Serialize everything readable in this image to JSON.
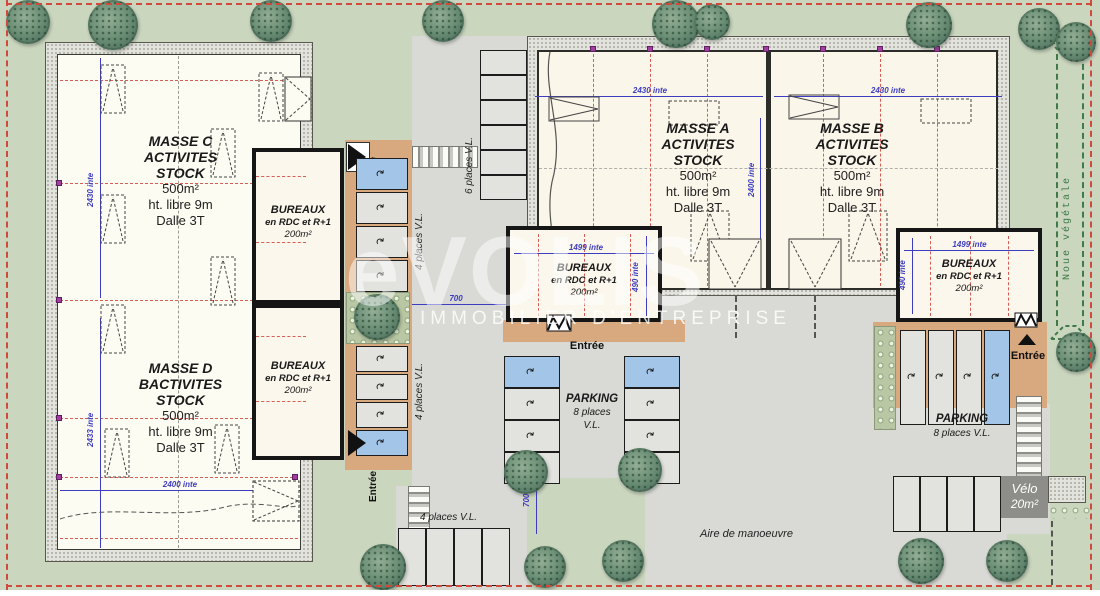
{
  "watermark": {
    "logo": "eVOLIS",
    "tagline": "IMMOBILIER D'ENTREPRISE"
  },
  "buildings": {
    "masse_c": {
      "lines": [
        "MASSE C",
        "ACTIVITES",
        "STOCK",
        "500m²",
        "ht. libre 9m",
        "Dalle 3T"
      ]
    },
    "masse_d": {
      "lines": [
        "MASSE D",
        "BACTIVITES",
        "STOCK",
        "500m²",
        "ht. libre 9m",
        "Dalle 3T"
      ]
    },
    "masse_a": {
      "lines": [
        "MASSE A",
        "ACTIVITES",
        "STOCK",
        "500m²",
        "ht. libre 9m",
        "Dalle 3T"
      ]
    },
    "masse_b": {
      "lines": [
        "MASSE B",
        "ACTIVITES",
        "STOCK",
        "500m²",
        "ht. libre 9m",
        "Dalle 3T"
      ]
    },
    "bureaux": {
      "lines": [
        "BUREAUX",
        "en RDC et R+1",
        "200m²"
      ]
    }
  },
  "labels": {
    "entree": "Entrée",
    "places4": "4 places V.L.",
    "places6": "6 places V.L.",
    "parking_central": [
      "PARKING",
      "8 places",
      "V.L."
    ],
    "parking_right": [
      "PARKING",
      "8 places V.L."
    ],
    "velo": [
      "Vélo",
      "20m²"
    ],
    "aire": "Aire de manoeuvre",
    "noue": "Noue végétale",
    "handicap_icon": "♿",
    "car_icon": "↷"
  },
  "dimensions": {
    "left_top_v": "2430 inte",
    "left_bottom_v": "2433 inte",
    "left_bottom_h": "2400 inte",
    "masse_a_h": "2430 inte",
    "masse_b_h": "2430 inte",
    "right_mid_v": "2400 inte",
    "bureaux_w": "1499 inte",
    "bureaux_h": "490 inte",
    "road_w": "700",
    "road_s": "700"
  },
  "colors": {
    "site_green": "#cbd6bf",
    "road_gray": "#d9d9d5",
    "walkway_tan": "#d8a87e",
    "handicap_blue": "#a3c6e8",
    "boundary_red": "#cf4a3d",
    "grid_red": "#d95d55",
    "dim_blue": "#3d3dc0",
    "noue_green": "#3f7a48"
  }
}
